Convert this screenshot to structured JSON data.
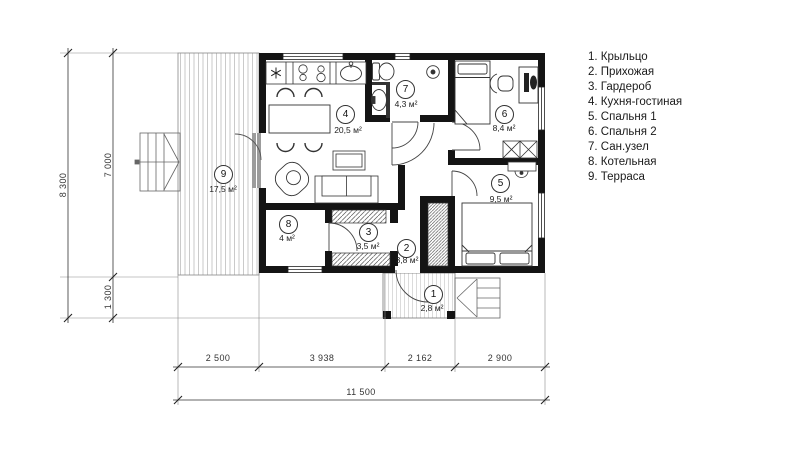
{
  "legend": {
    "items": [
      "1. Крыльцо",
      "2. Прихожая",
      "3. Гардероб",
      "4. Кухня-гостиная",
      "5. Спальня 1",
      "6. Спальня 2",
      "7. Сан.узел",
      "8. Котельная",
      "9. Терраса"
    ]
  },
  "rooms": [
    {
      "number": "1",
      "area": "2,8 м²"
    },
    {
      "number": "2",
      "area": "3,8 м²"
    },
    {
      "number": "3",
      "area": "3,5 м²"
    },
    {
      "number": "4",
      "area": "20,5 м²"
    },
    {
      "number": "5",
      "area": "9,5 м²"
    },
    {
      "number": "6",
      "area": "8,4 м²"
    },
    {
      "number": "7",
      "area": "4,3 м²"
    },
    {
      "number": "8",
      "area": "4 м²"
    },
    {
      "number": "9",
      "area": "17,5 м²"
    }
  ],
  "dimensions": {
    "bottom_segments": [
      "2 500",
      "3 938",
      "2 162",
      "2 900"
    ],
    "bottom_total": "11 500",
    "left_segments": [
      "7 000",
      "1 300"
    ],
    "left_total": "8 300"
  },
  "colors": {
    "wall": "#141414",
    "line": "#333333",
    "hatch": "#c4c4c4"
  }
}
